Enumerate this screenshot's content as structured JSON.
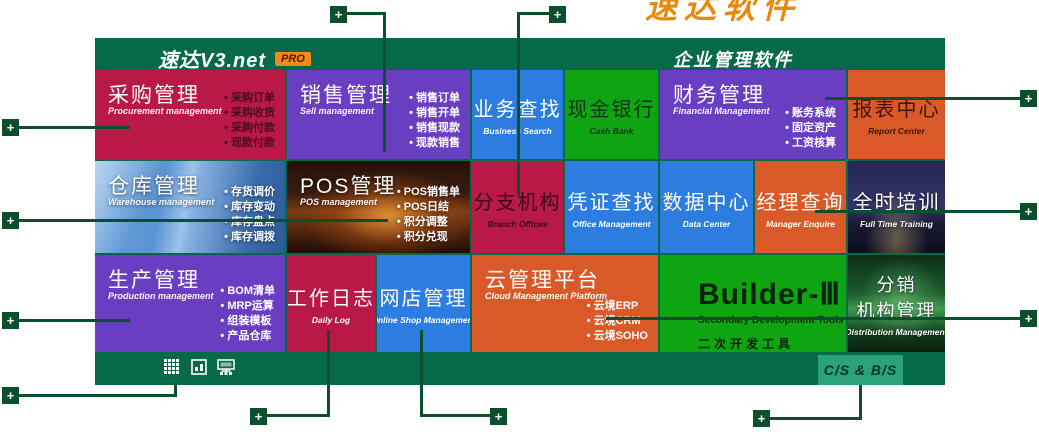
{
  "header": {
    "brand": "速达V3.net",
    "brand_badge": "PRO",
    "product_title": "企业管理软件"
  },
  "watermark": {
    "text": "速达软件"
  },
  "tiles": {
    "procurement": {
      "title": "采购管理",
      "subtitle": "Procurement management",
      "bullets": [
        "采购订单",
        "采购收货",
        "采购付款",
        "现款付款"
      ]
    },
    "sell": {
      "title": "销售管理",
      "subtitle": "Sell management",
      "bullets": [
        "销售订单",
        "销售开单",
        "销售现款",
        "现款销售"
      ]
    },
    "business_search": {
      "title": "业务查找",
      "subtitle": "Business Search"
    },
    "cash_bank": {
      "title": "现金银行",
      "subtitle": "Cash Bank"
    },
    "financial": {
      "title": "财务管理",
      "subtitle": "Financial Management",
      "bullets": [
        "账务系统",
        "固定资产",
        "工资核算"
      ]
    },
    "report_center": {
      "title": "报表中心",
      "subtitle": "Report Center"
    },
    "warehouse": {
      "title": "仓库管理",
      "subtitle": "Warehouse management",
      "bullets": [
        "存货调价",
        "库存变动",
        "库存盘点",
        "库存调拨"
      ]
    },
    "pos": {
      "title": "POS管理",
      "subtitle": "POS management",
      "bullets": [
        "POS销售单",
        "POS日结",
        "积分调整",
        "积分兑现"
      ]
    },
    "branch": {
      "title": "分支机构",
      "subtitle": "Branch Offices"
    },
    "voucher_search": {
      "title": "凭证查找",
      "subtitle": "Office Management"
    },
    "data_center": {
      "title": "数据中心",
      "subtitle": "Data Center"
    },
    "manager_enquire": {
      "title": "经理查询",
      "subtitle": "Manager Enquire"
    },
    "training": {
      "title": "全时培训",
      "subtitle": "Full Time Training"
    },
    "production": {
      "title": "生产管理",
      "subtitle": "Production management",
      "bullets": [
        "BOM清单",
        "MRP运算",
        "组装模板",
        "产品仓库"
      ]
    },
    "daily_log": {
      "title": "工作日志",
      "subtitle": "Daily Log"
    },
    "online_shop": {
      "title": "网店管理",
      "subtitle": "Online Shop Management"
    },
    "cloud": {
      "title": "云管理平台",
      "subtitle": "Cloud Management Platform",
      "bullets": [
        "云境ERP",
        "云境CRM",
        "云境SOHO"
      ]
    },
    "builder": {
      "title": "Builder-Ⅲ",
      "subtitle_en": "Secondary Development Tools",
      "subtitle_cn": "二次开发工具"
    },
    "distribution": {
      "title_line1": "分销",
      "title_line2": "机构管理",
      "subtitle": "Distribution Management"
    }
  },
  "bottom_bar": {
    "cs_bs_label": "C/S & B/S",
    "icons": [
      "grid-view-icon",
      "report-window-icon",
      "network-monitor-icon"
    ]
  },
  "connectors": {
    "plus": "+"
  },
  "colors": {
    "panel_green": "#066949",
    "connector_green": "#0b4f2c",
    "tile_crimson": "#b81947",
    "tile_purple": "#6a3ec0",
    "tile_blue": "#2d7de0",
    "tile_green": "#0fa512",
    "tile_orange": "#d95a28",
    "pro_badge_orange": "#f28b16",
    "cs_badge_green": "#2aa378",
    "watermark_orange": "#e8890c"
  }
}
